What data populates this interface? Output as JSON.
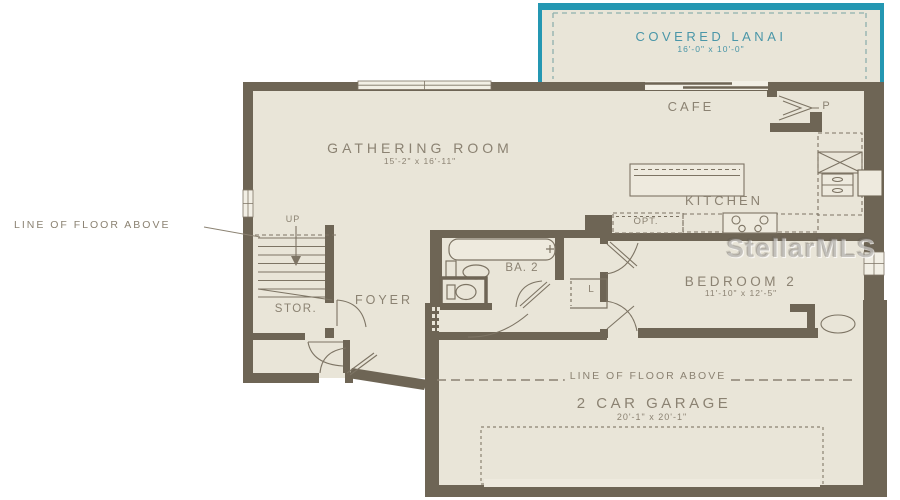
{
  "image_type": "residential floor plan (first floor)",
  "watermark": "StellarMLS",
  "rooms": {
    "covered_lanai": {
      "label": "COVERED LANAI",
      "dims": "16'-0\" x 10'-0\""
    },
    "gathering_room": {
      "label": "GATHERING ROOM",
      "dims": "15'-2\" x 16'-11\""
    },
    "cafe": {
      "label": "CAFE"
    },
    "kitchen": {
      "label": "KITCHEN"
    },
    "pantry": {
      "label": "P"
    },
    "optional_feature": {
      "label": "OPT."
    },
    "bath_2": {
      "label": "BA. 2"
    },
    "linen": {
      "label": "L"
    },
    "bedroom_2": {
      "label": "BEDROOM 2",
      "dims": "11'-10\" x 12'-5\""
    },
    "stairs": {
      "label": "UP"
    },
    "storage": {
      "label": "STOR."
    },
    "foyer": {
      "label": "FOYER"
    },
    "garage": {
      "label": "2 CAR GARAGE",
      "dims": "20'-1\" x 20'-1\""
    }
  },
  "annotations": {
    "floor_above_left": "LINE OF FLOOR ABOVE",
    "floor_above_garage": "LINE OF FLOOR ABOVE"
  },
  "colors": {
    "wall": "#6e6555",
    "floor": "#e9e5d8",
    "accent_teal": "#2497b2",
    "label_text": "#8b8272",
    "lanai_text": "#4a96a8",
    "background": "#ffffff"
  }
}
